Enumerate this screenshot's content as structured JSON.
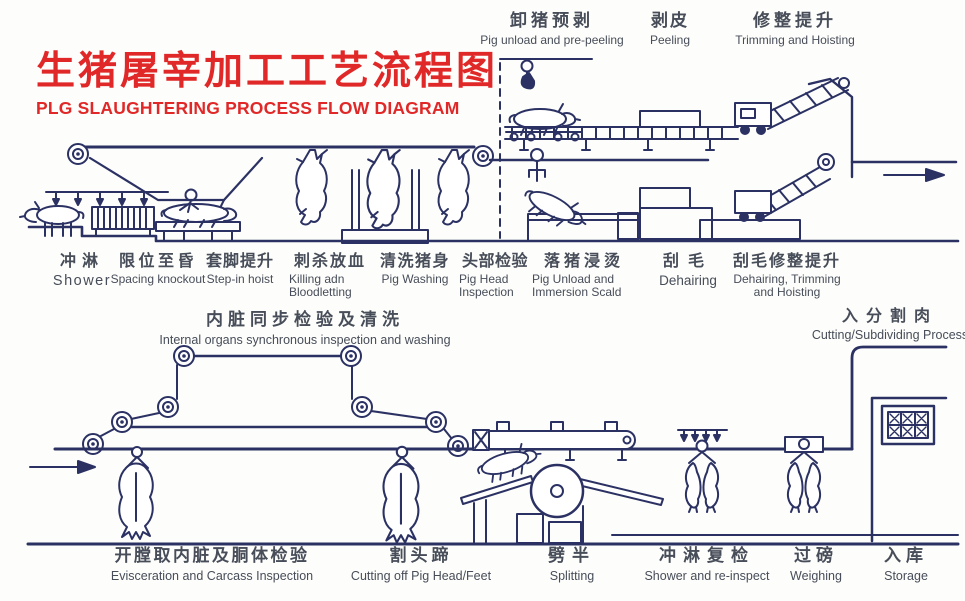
{
  "title": {
    "cn": "生猪屠宰加工工艺流程图",
    "en": "PLG SLAUGHTERING PROCESS FLOW DIAGRAM"
  },
  "colors": {
    "accent_red": "#e02828",
    "line_navy": "#2b3263",
    "label_ink": "#474d59",
    "background": "#fdfdfb"
  },
  "top_labels": [
    {
      "cn": "卸猪预剥",
      "en": "Pig unload and pre-peeling"
    },
    {
      "cn": "剥皮",
      "en": "Peeling"
    },
    {
      "cn": "修整提升",
      "en": "Trimming and Hoisting"
    }
  ],
  "upper_stations": [
    {
      "cn": "冲淋",
      "en": "Shower"
    },
    {
      "cn": "限位至昏",
      "en": "Spacing knockout"
    },
    {
      "cn": "套脚提升",
      "en": "Step-in hoist"
    },
    {
      "cn": "刺杀放血",
      "en": "Killing adn Bloodletting"
    },
    {
      "cn": "清洗猪身",
      "en": "Pig Washing"
    },
    {
      "cn": "头部检验",
      "en": "Pig Head Inspection"
    },
    {
      "cn": "落猪浸烫",
      "en": "Pig Unload and Immersion Scald"
    },
    {
      "cn": "刮毛",
      "en": "Dehairing"
    },
    {
      "cn": "刮毛修整提升",
      "en": "Dehairing, Trimming and Hoisting"
    }
  ],
  "mid_labels": [
    {
      "cn": "内脏同步检验及清洗",
      "en": "Internal organs synchronous inspection and washing"
    },
    {
      "cn": "入分割肉",
      "en": "Cutting/Subdividing Process"
    }
  ],
  "lower_stations": [
    {
      "cn": "开膛取内脏及胴体检验",
      "en": "Evisceration and Carcass Inspection"
    },
    {
      "cn": "割头蹄",
      "en": "Cutting off Pig Head/Feet"
    },
    {
      "cn": "劈半",
      "en": "Splitting"
    },
    {
      "cn": "冲淋复检",
      "en": "Shower and re-inspect"
    },
    {
      "cn": "过磅",
      "en": "Weighing"
    },
    {
      "cn": "入库",
      "en": "Storage"
    }
  ]
}
